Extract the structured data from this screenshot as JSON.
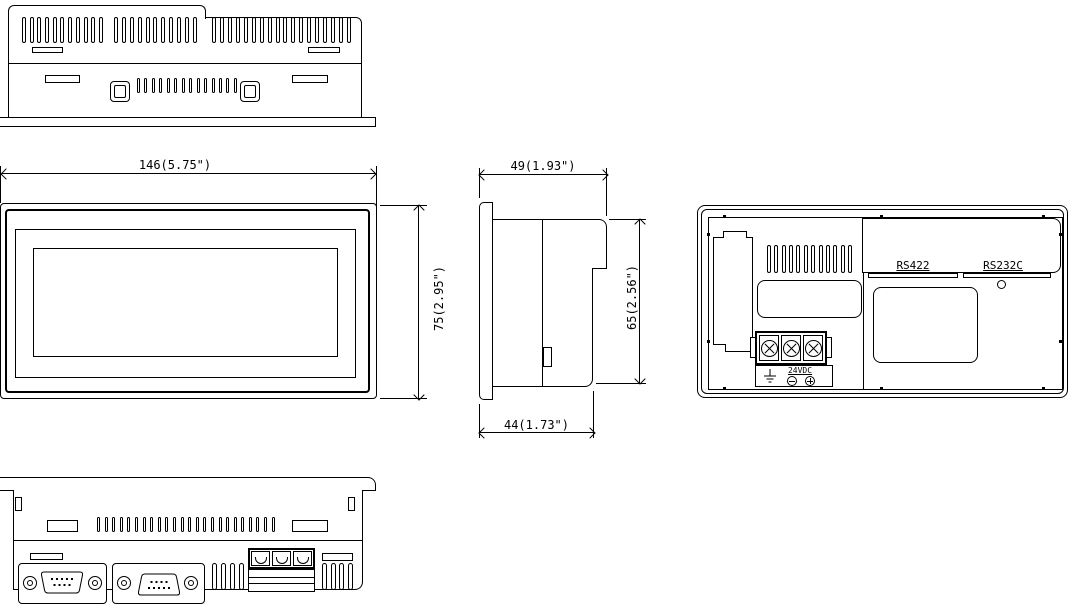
{
  "drawing": {
    "dimensions": {
      "width": "146(5.75\")",
      "height": "75(2.95\")",
      "depth_total": "49(1.93\")",
      "panel_height": "65(2.56\")",
      "depth_body": "44(1.73\")"
    },
    "ports": {
      "rs422": "RS422",
      "rs232c": "RS232C"
    },
    "power": {
      "label": "24VDC"
    },
    "colors": {
      "line": "#000000",
      "background": "#ffffff"
    }
  }
}
